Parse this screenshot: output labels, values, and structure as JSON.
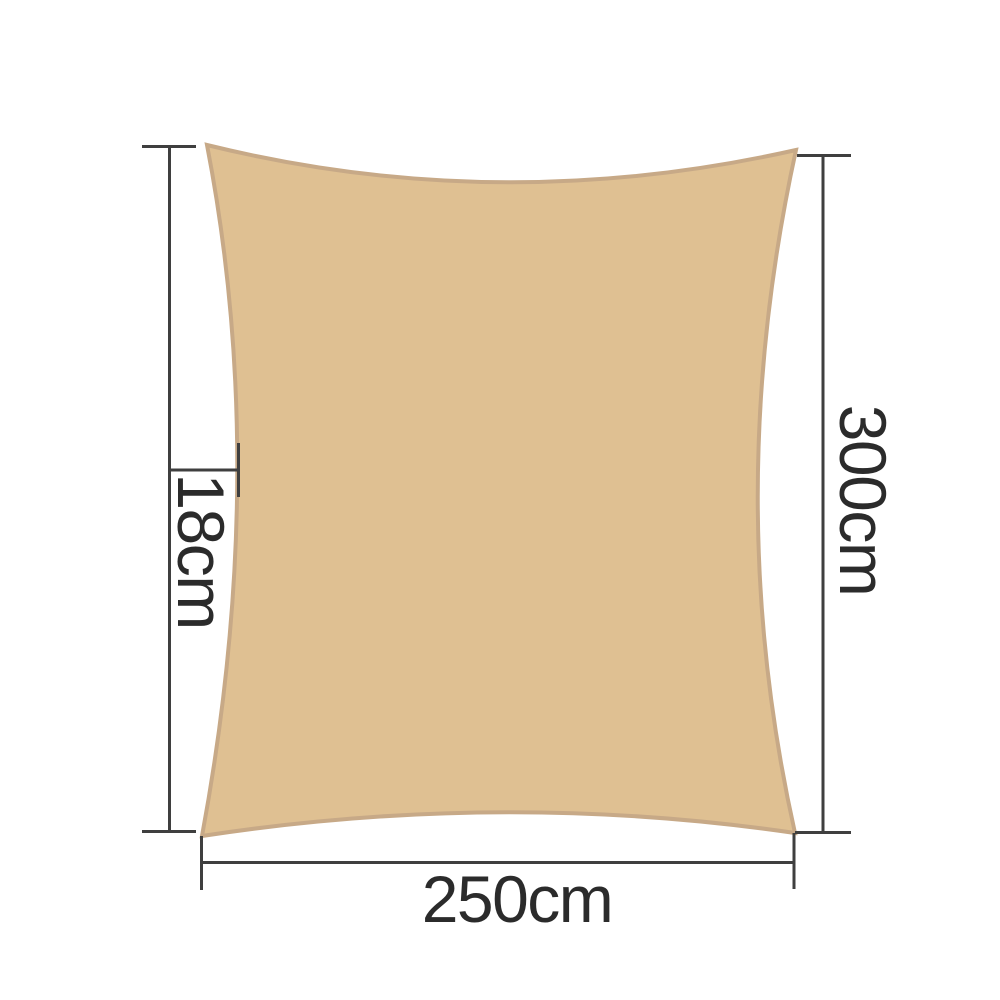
{
  "page": {
    "background_color": "#ffffff"
  },
  "diagram": {
    "sail": {
      "shape": "rectangle-with-concave-edges",
      "fill_color": "#dfc092",
      "edge_color": "#c7a987"
    },
    "annotation": {
      "line_color": "#3f3f3f",
      "text_color": "#2b2b2b"
    },
    "dimension_labels": {
      "left_vertical": "18cm",
      "right_vertical": "300cm",
      "bottom_horizontal": "250cm"
    }
  }
}
